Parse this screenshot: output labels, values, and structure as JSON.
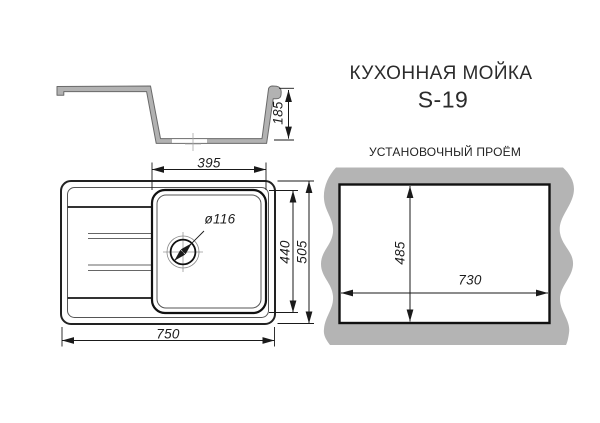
{
  "header": {
    "title": "КУХОННАЯ МОЙКА",
    "model": "S-19"
  },
  "side_view": {
    "depth_label": "185"
  },
  "top_view": {
    "bowl_width_label": "395",
    "bowl_length_label": "440",
    "overall_length_label": "505",
    "overall_width_label": "750",
    "drain_diameter_label": "ø116"
  },
  "cutout_panel": {
    "title": "УСТАНОВОЧНЫЙ ПРОЁМ",
    "cutout_width_label": "730",
    "cutout_height_label": "485"
  },
  "colors": {
    "countertop_gray": "#b4b4b4",
    "profile_gray": "#b2b2b2",
    "line_dark": "#1a1a1a",
    "line_medium": "#555555"
  }
}
